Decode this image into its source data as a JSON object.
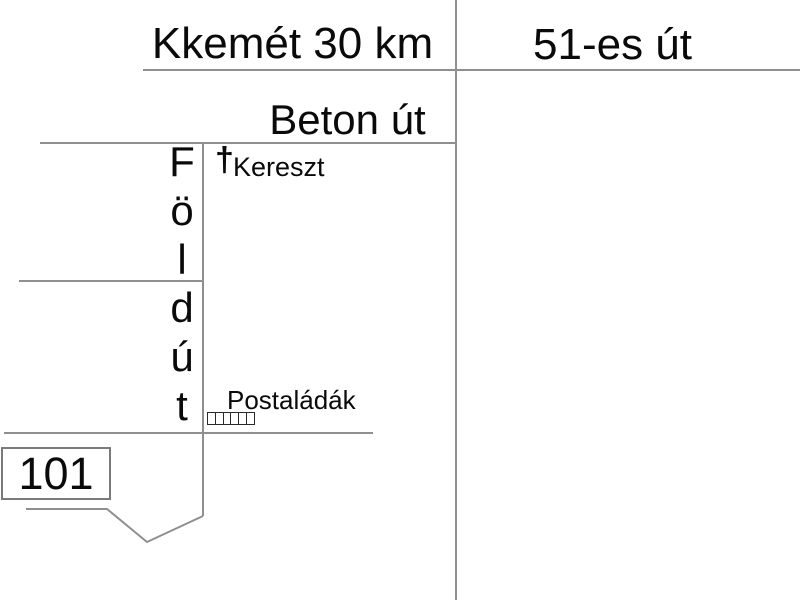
{
  "title": "Hand-drawn route sketch map",
  "colors": {
    "background": "#ffffff",
    "road_line": "#8f8f8f",
    "text": "#0a0a0a",
    "house_box_border": "#7a7a7a",
    "mailbox_border": "#2a2a2a"
  },
  "labels": {
    "destination": "Kkemét 30 km",
    "main_road": "51-es út",
    "concrete_road": "Beton út",
    "dirt_road": {
      "label": "Föld út",
      "letters": [
        "F",
        "ö",
        "l",
        "d",
        "ú",
        "t"
      ]
    },
    "cross": {
      "symbol": "†",
      "label": "Kereszt"
    },
    "mailboxes": {
      "label": "Postaládák",
      "count": 6
    },
    "house_number": "101"
  }
}
